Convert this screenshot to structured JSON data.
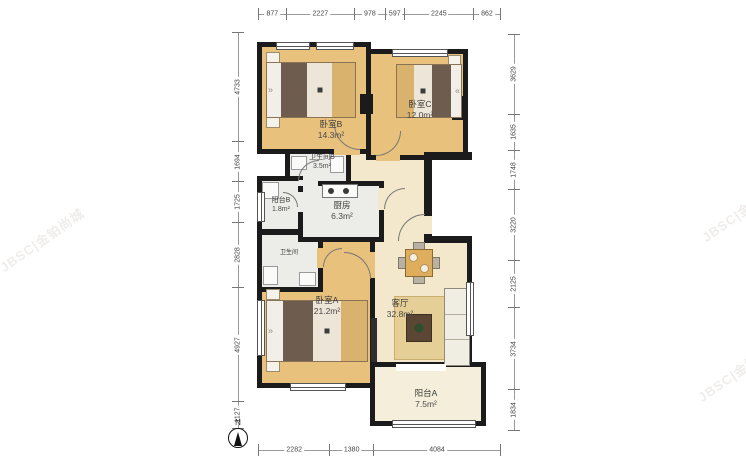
{
  "compass": {
    "label": "N"
  },
  "watermark": {
    "text": "JBSC|金铂尚城"
  },
  "dimensions": {
    "top": [
      "877",
      "2227",
      "978",
      "597",
      "2245",
      "862"
    ],
    "bottom": [
      "2282",
      "1380",
      "4084"
    ],
    "left": [
      "4733",
      "1694",
      "1725",
      "2828",
      "4927",
      "1127"
    ],
    "right": [
      "3629",
      "1635",
      "1748",
      "3220",
      "2125",
      "3734",
      "1834"
    ]
  },
  "rooms": {
    "bedroom_b": {
      "name": "卧室B",
      "area": "14.3m²"
    },
    "bedroom_c": {
      "name": "卧室C",
      "area": "12.0m²"
    },
    "bath_b": {
      "name": "卫生间B",
      "area": "3.5m²"
    },
    "balcony_b": {
      "name": "阳台B",
      "area": "1.8m²"
    },
    "kitchen": {
      "name": "厨房",
      "area": "6.3m²"
    },
    "bath": {
      "name": "卫生间",
      "area": ""
    },
    "bedroom_a": {
      "name": "卧室A",
      "area": "21.2m²"
    },
    "living": {
      "name": "客厅",
      "area": "32.8m²"
    },
    "balcony_a": {
      "name": "阳台A",
      "area": "7.5m²"
    }
  },
  "colors": {
    "wall": "#1b1b1b",
    "floor_bedroom": "#e8c27c",
    "floor_living": "#f3e8cc",
    "floor_service": "#ecece8",
    "floor_balcony": "#f4eeda"
  }
}
